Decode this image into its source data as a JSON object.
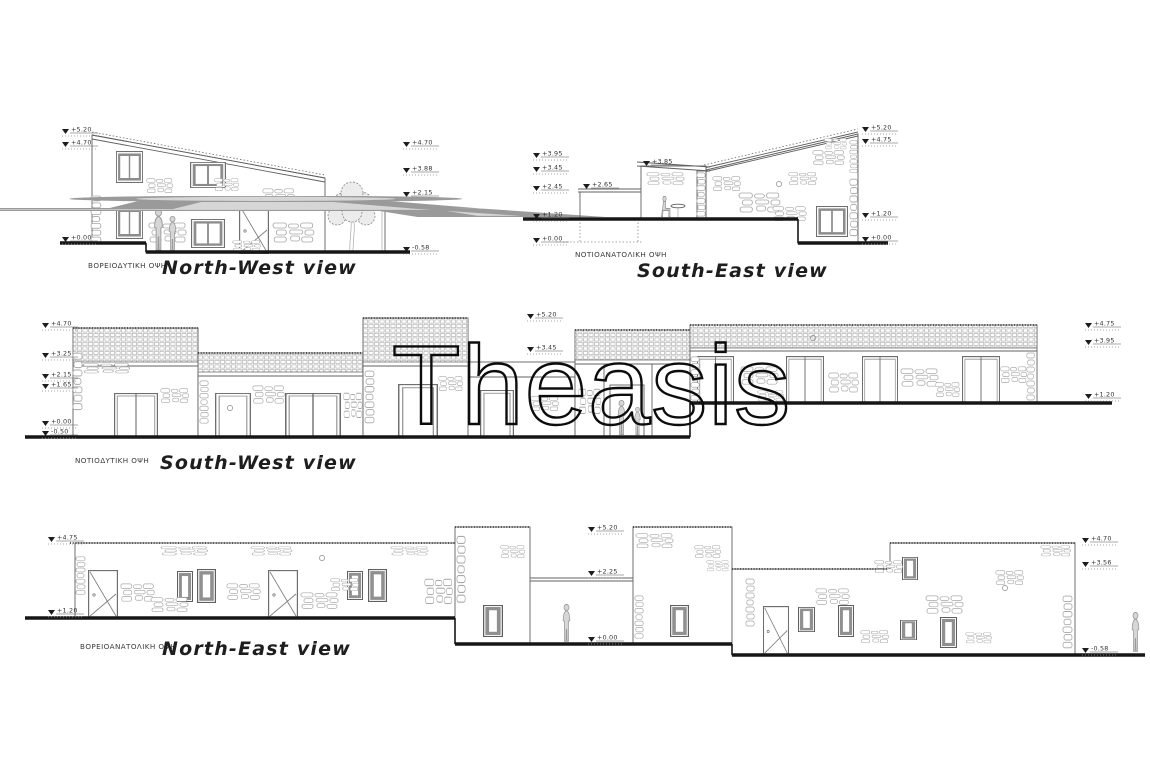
{
  "watermark": "Theasis",
  "views": {
    "nw": {
      "label_greek": "ΒΟΡΕΙΟΔΥΤΙΚΗ ΟΨΗ",
      "title": "North-West view",
      "markers_left": [
        "+5.20",
        "+4.70",
        "+0.00"
      ],
      "markers_right": [
        "+4.70",
        "+3.88",
        "+2.15",
        "-0.58"
      ]
    },
    "se": {
      "label_greek": "ΝΟΤΙΟΑΝΑΤΟΛΙΚΗ ΟΨΗ",
      "title": "South-East view",
      "markers_left": [
        "+3.95",
        "+3.45",
        "+2.45",
        "+1.20",
        "+0.00"
      ],
      "markers_mid": [
        "+2.65",
        "+3.85"
      ],
      "markers_right": [
        "+5.20",
        "+4.75",
        "+1.20",
        "+0.00"
      ]
    },
    "sw": {
      "label_greek": "ΝΟΤΙΟΔΥΤΙΚΗ ΟΨΗ",
      "title": "South-West view",
      "markers_left": [
        "+4.70",
        "+3.25",
        "+2.15",
        "+1.65",
        "+0.00",
        "-0.50"
      ],
      "markers_mid": [
        "+5.20",
        "+3.45"
      ],
      "markers_right": [
        "+4.75",
        "+3.95",
        "+1.20"
      ]
    },
    "ne": {
      "label_greek": "ΒΟΡΕΙΟΑΝΑΤΟΛΙΚΗ ΟΨΗ",
      "title": "North-East view",
      "markers_left": [
        "+4.75",
        "+1.20"
      ],
      "markers_mid": [
        "+5.20",
        "+2.25",
        "+0.00"
      ],
      "markers_right": [
        "+4.70",
        "+3.56",
        "-0.58"
      ]
    }
  },
  "colors": {
    "line": "#606060",
    "ground": "#161616",
    "stone": "#a8a8a8",
    "watermark": "#0c0c0c"
  }
}
